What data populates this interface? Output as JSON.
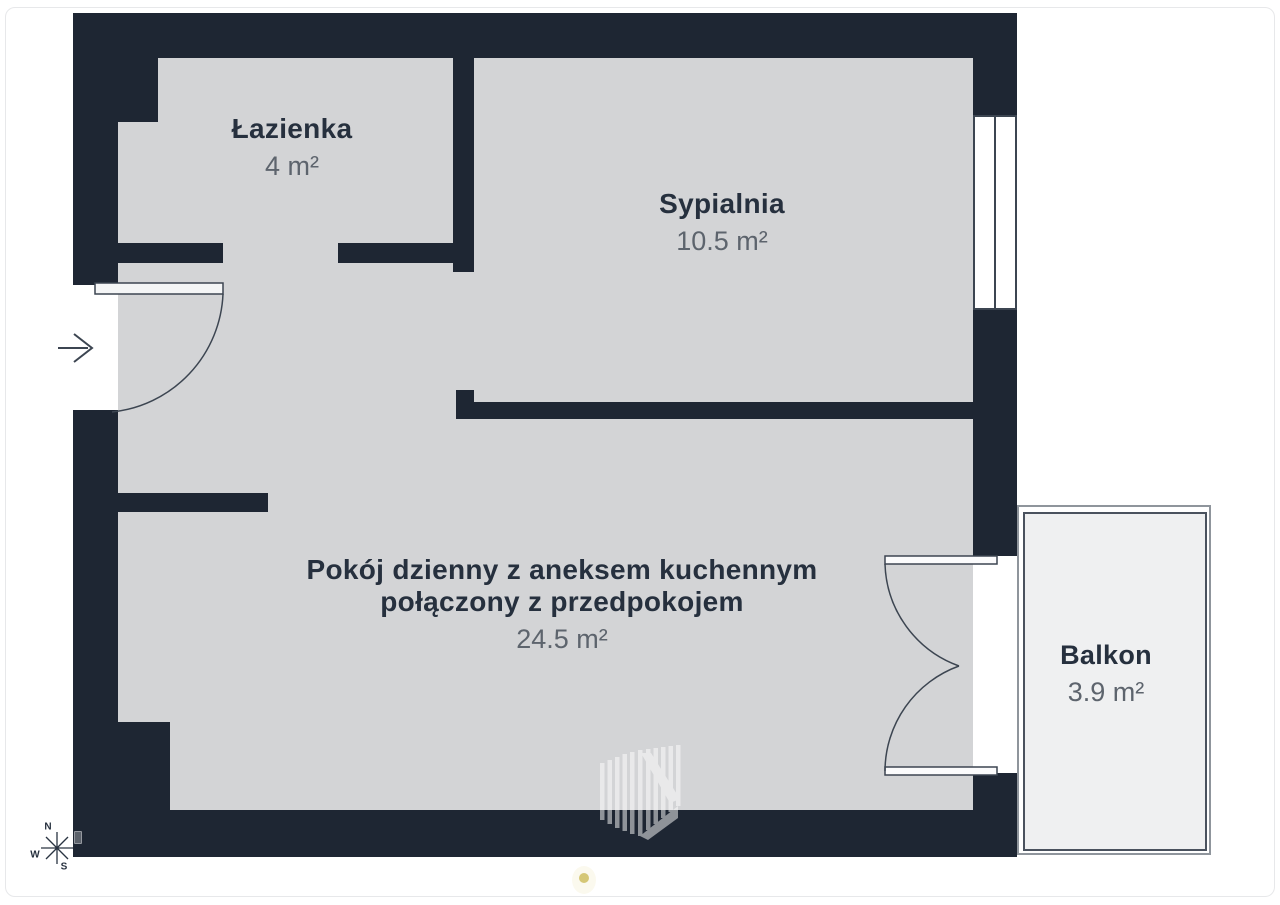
{
  "colors": {
    "wall": "#1e2633",
    "floor": "#d3d4d6",
    "balcony-floor": "#eff0f1",
    "line": "#3c4551",
    "ink": "#26303e",
    "muted": "#5d646d",
    "border": "#e7e8ea",
    "outer-line": "#8f959c",
    "inner-line": "#4a525e",
    "dot": "#d5c776"
  },
  "rooms": {
    "bathroom": {
      "label": "Łazienka",
      "area": "4 m²"
    },
    "bedroom": {
      "label": "Sypialnia",
      "area": "10.5 m²"
    },
    "living": {
      "label_line1": "Pokój dzienny z aneksem kuchennym",
      "label_line2": "połączony z przedpokojem",
      "area": "24.5 m²"
    },
    "balcony": {
      "label": "Balkon",
      "area": "3.9 m²"
    }
  },
  "compass": {
    "n": "N",
    "w": "W",
    "s": "S"
  }
}
